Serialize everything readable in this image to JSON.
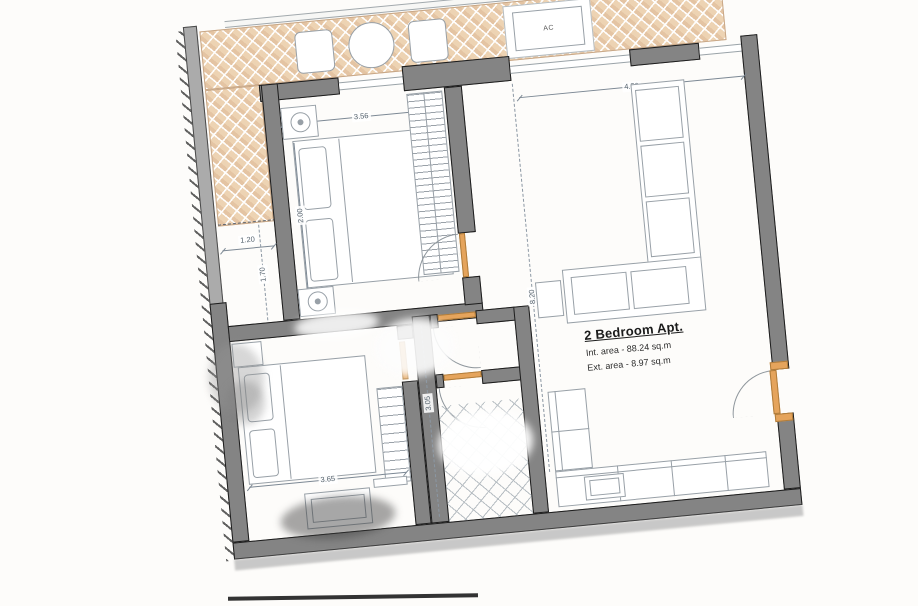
{
  "title_block": {
    "title": "2 Bedroom Apt.",
    "int_area": "Int. area - 88.24 sq.m",
    "ext_area": "Ext. area - 8.97 sq.m"
  },
  "terrace": {
    "ac_label": "AC"
  },
  "dimensions": {
    "bedroom1_width": "3.56",
    "bedroom1_bed": "2.00",
    "terrace_strip_width": "1.20",
    "terrace_strip_length": "1.70",
    "living_width": "4.56",
    "living_length": "8.20",
    "bedroom2_width": "3.65",
    "hall_length": "3.05"
  },
  "colors": {
    "wall_fill": "#848484",
    "wall_outline": "#1c1c1c",
    "terrace_tile": "#edd3b3",
    "door_accent": "#e5a45c",
    "dimension_text": "#54616c",
    "furniture_line": "#98a0a7"
  }
}
